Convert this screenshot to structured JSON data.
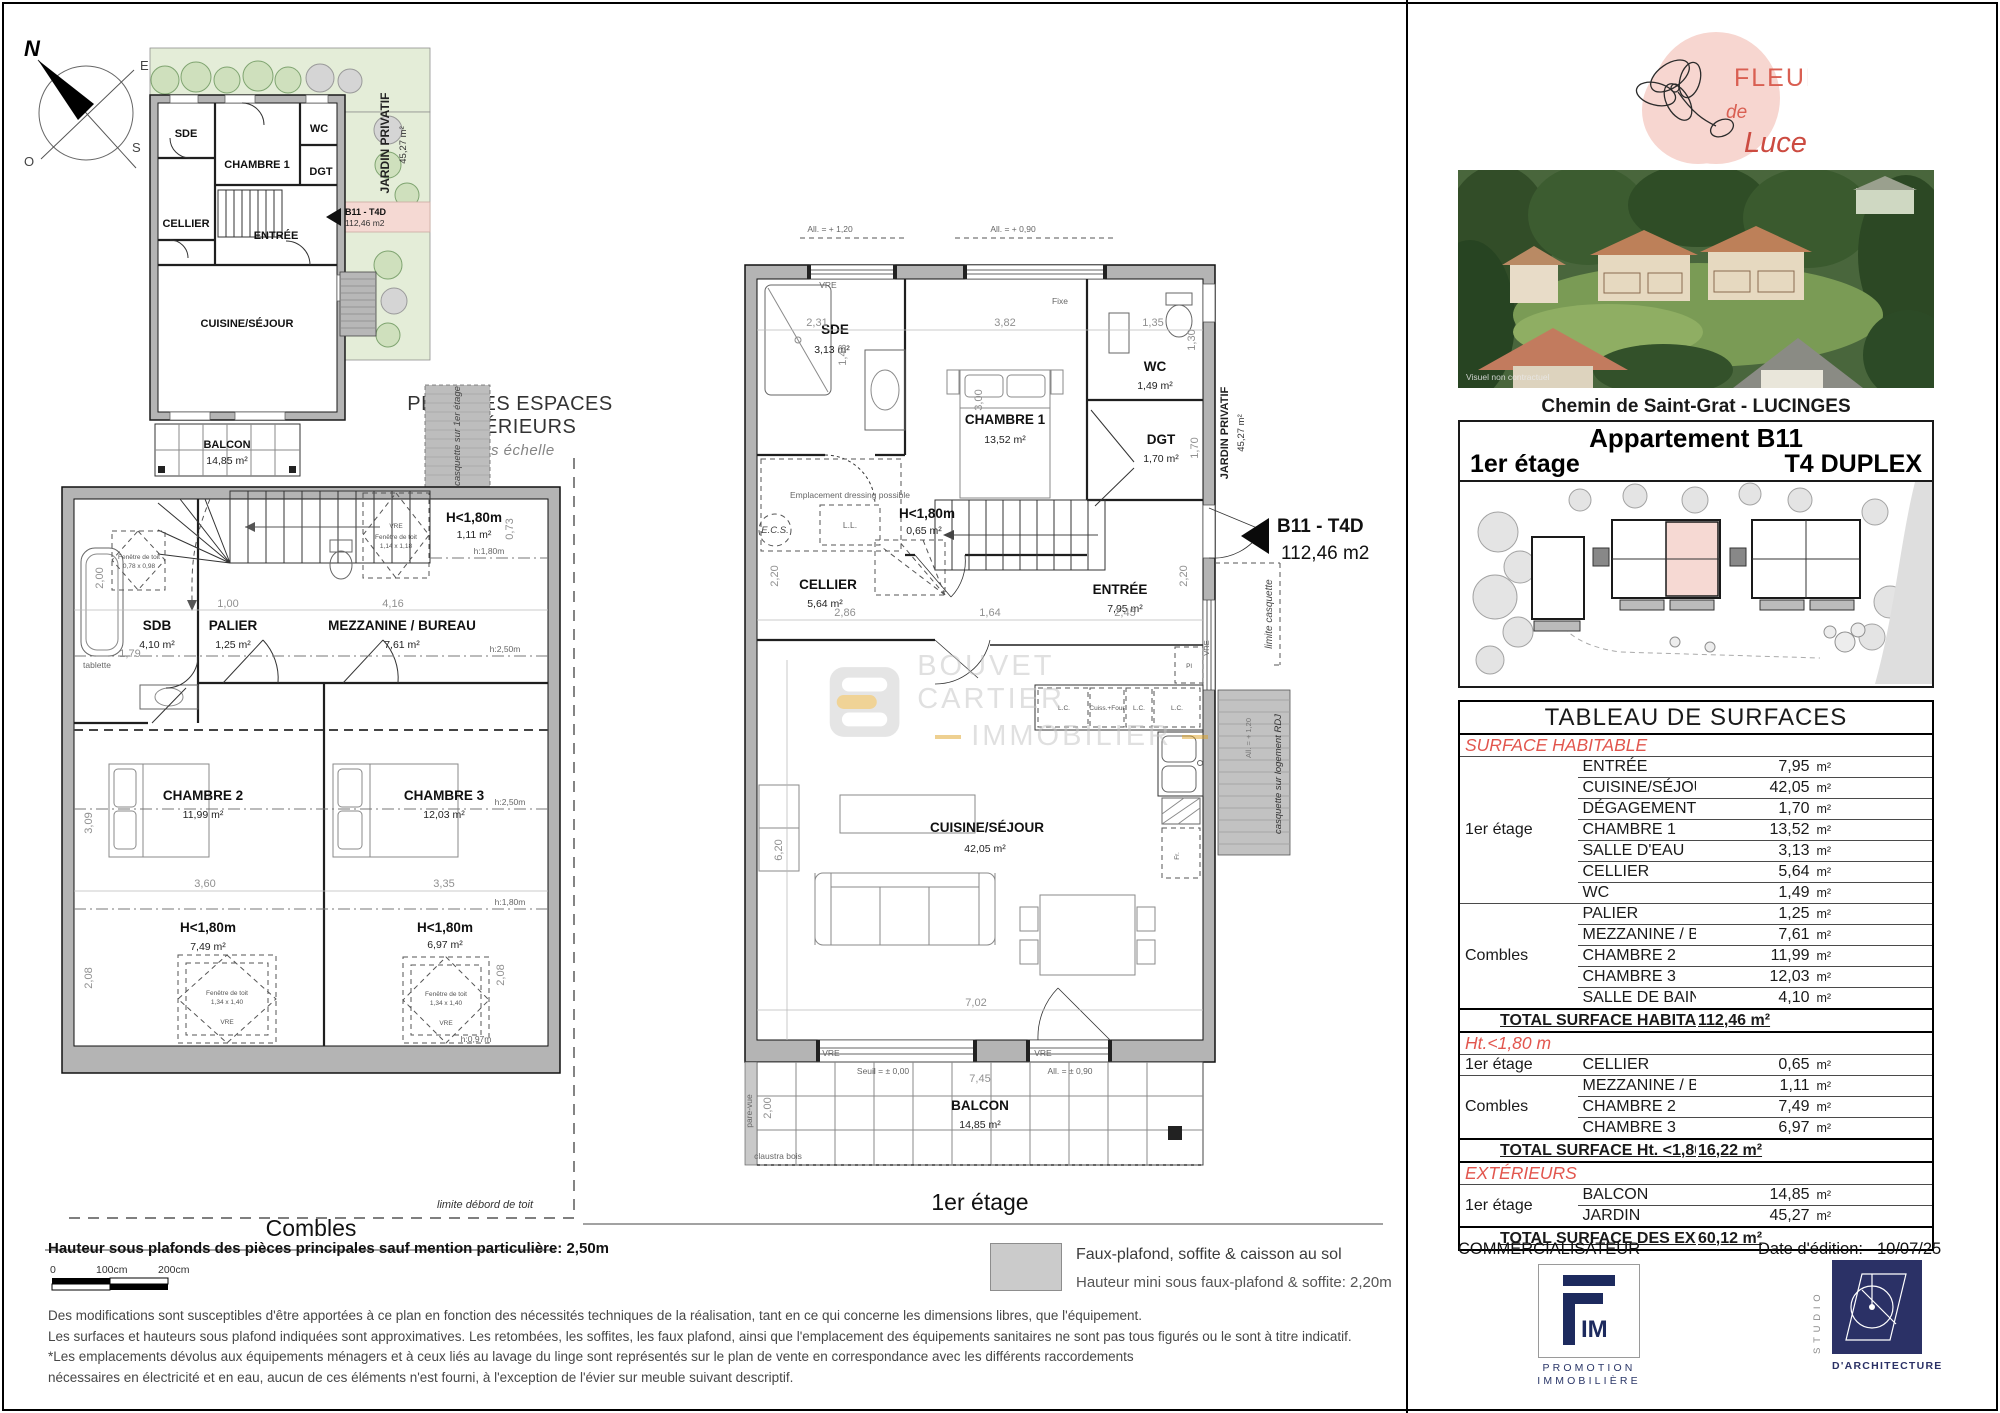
{
  "doc": {
    "commercialisateur": "COMMERCIALISATEUR",
    "edition_label": "Date d'édition:",
    "edition_date": "10/07/25"
  },
  "compass": {
    "n": "N",
    "e": "E",
    "s": "S",
    "o": "O"
  },
  "pe": {
    "title": "PLAN DES ESPACES EXTÉRIEURS",
    "subtitle": "sans échelle",
    "sde": "SDE",
    "ch1": "CHAMBRE 1",
    "wc": "WC",
    "dgt": "DGT",
    "cellier": "CELLIER",
    "entree": "ENTRÉE",
    "cuisine": "CUISINE/SÉJOUR",
    "balcon": "BALCON",
    "balcon_a": "14,85 m²",
    "jardin": "JARDIN PRIVATIF",
    "jardin_a": "45,27 m²",
    "tag_code": "B11 - T4D",
    "tag_area": "112,46 m2"
  },
  "pc": {
    "caption": "Combles",
    "sdb": "SDB",
    "sdb_a": "4,10 m²",
    "palier": "PALIER",
    "palier_a": "1,25 m²",
    "mez": "MEZZANINE / BUREAU",
    "mez_a": "7,61 m²",
    "ch2": "CHAMBRE 2",
    "ch2_a": "11,99 m²",
    "ch3": "CHAMBRE 3",
    "ch3_a": "12,03 m²",
    "h180": "H<1,80m",
    "h180_top_a": "1,11 m²",
    "h180_l_a": "7,49 m²",
    "h180_r_a": "6,97 m²",
    "hl250": "h:2,50m",
    "hl180": "h:1,80m",
    "hl097": "h:0,97m",
    "tablette": "tablette",
    "vre": "VRE",
    "ft": "Fenêtre de toit",
    "ft1_s": "0,78 x 0,98",
    "ft2_s": "1,14 x 1,18",
    "ft3_s": "1,34 x 1,40",
    "casquette": "casquette sur 1er étage",
    "limite": "limite débord de toit",
    "d200": "2,00",
    "d179": "1,79",
    "d100": "1,00",
    "d416": "4,16",
    "d073": "0,73",
    "d360": "3,60",
    "d335": "3,35",
    "d309": "3,09",
    "d208": "2,08"
  },
  "p1": {
    "caption": "1er étage",
    "sde": "SDE",
    "sde_a": "3,13 m²",
    "ch1": "CHAMBRE 1",
    "ch1_a": "13,52 m²",
    "wc": "WC",
    "wc_a": "1,49 m²",
    "dgt": "DGT",
    "dgt_a": "1,70 m²",
    "cellier": "CELLIER",
    "cellier_a": "5,64 m²",
    "entree": "ENTRÉE",
    "entree_a": "7,95 m²",
    "cuisine": "CUISINE/SÉJOUR",
    "cuisine_a": "42,05 m²",
    "balcon": "BALCON",
    "balcon_a": "14,85 m²",
    "h180": "H<1,80m",
    "h180_a": "0,65 m²",
    "dressing": "Emplacement dressing possible",
    "ecs": "E.C.S.",
    "ll": "L.L.",
    "lc": "L.C.",
    "cuiss": "Cuiss.+Four",
    "pl": "Pl",
    "fr": "Fr.",
    "vre": "VRE",
    "fixe": "Fixe",
    "all120": "All. = + 1,20",
    "all090": "All. = + 0,90",
    "seuil": "Seuil = ± 0,00",
    "all090b": "All. = ± 0,90",
    "pare": "pare-vue",
    "claustra": "claustra bois",
    "jardin": "JARDIN PRIVATIF",
    "jardin_a": "45,27 m²",
    "lim_casq": "limite casquette",
    "casq_rdj": "casquette sur logement RDJ",
    "tag_code": "B11 - T4D",
    "tag_area": "112,46 m2",
    "d231": "2,31",
    "d143": "1,43",
    "d382": "3,82",
    "d300": "3,00",
    "d135": "1,35",
    "d130": "1,30",
    "d170": "1,70",
    "d220": "2,20",
    "d286": "2,86",
    "d164": "1,64",
    "d245": "2,45",
    "d620": "6,20",
    "d702": "7,02",
    "d745": "7,45",
    "d200": "2,00"
  },
  "wm": {
    "l1": "BOUVET CARTIER",
    "l2": "IMMOBILIER"
  },
  "brand": {
    "l1": "FLEUR",
    "l2": "de",
    "l3": "Luce"
  },
  "photo": {
    "caption": "Visuel non contractuel"
  },
  "right": {
    "address": "Chemin de Saint-Grat - LUCINGES",
    "apt": "Appartement B11",
    "floor": "1er étage",
    "type": "T4 DUPLEX"
  },
  "tab": {
    "title": "TABLEAU DE SURFACES",
    "unit": "m²",
    "sec1": "SURFACE HABITABLE",
    "sec2": "Ht.<1,80 m",
    "sec3": "EXTÉRIEURS",
    "g1n": "1er étage",
    "g2n": "Combles",
    "g3n": "1er étage",
    "g4n": "Combles",
    "g5n": "1er étage",
    "g1": [
      {
        "l": "ENTRÉE",
        "v": "7,95"
      },
      {
        "l": "CUISINE/SÉJOUR",
        "v": "42,05"
      },
      {
        "l": "DÉGAGEMENT",
        "v": "1,70"
      },
      {
        "l": "CHAMBRE 1",
        "v": "13,52"
      },
      {
        "l": "SALLE D'EAU",
        "v": "3,13"
      },
      {
        "l": "CELLIER",
        "v": "5,64"
      },
      {
        "l": "WC",
        "v": "1,49"
      }
    ],
    "g2": [
      {
        "l": "PALIER",
        "v": "1,25"
      },
      {
        "l": "MEZZANINE / BUREAU",
        "v": "7,61"
      },
      {
        "l": "CHAMBRE 2",
        "v": "11,99"
      },
      {
        "l": "CHAMBRE 3",
        "v": "12,03"
      },
      {
        "l": "SALLE DE BAINS",
        "v": "4,10"
      }
    ],
    "tot1l": "TOTAL SURFACE HABITABLE",
    "tot1v": "112,46 m²",
    "g3": [
      {
        "l": "CELLIER",
        "v": "0,65"
      }
    ],
    "g4": [
      {
        "l": "MEZZANINE / BUREAU",
        "v": "1,11"
      },
      {
        "l": "CHAMBRE 2",
        "v": "7,49"
      },
      {
        "l": "CHAMBRE 3",
        "v": "6,97"
      }
    ],
    "tot2l": "TOTAL SURFACE Ht. <1,80 m",
    "tot2v": "16,22 m²",
    "g5": [
      {
        "l": "BALCON",
        "v": "14,85"
      },
      {
        "l": "JARDIN",
        "v": "45,27"
      }
    ],
    "tot3l": "TOTAL SURFACE  DES EXTÉRIEURS",
    "tot3v": "60,12 m²"
  },
  "logos": {
    "fim_im": "IM",
    "fim_l1": "PROMOTION",
    "fim_l2": "IMMOBILIÈRE",
    "studio_side": "STUDIO",
    "studio_sub": "D'ARCHITECTURE"
  },
  "notes": {
    "height": "Hauteur sous plafonds des pièces principales sauf mention particulière: 2,50m",
    "s0": "0",
    "s1": "100cm",
    "s2": "200cm",
    "leg1": "Faux-plafond, soffite & caisson au sol",
    "leg2": "Hauteur mini sous faux-plafond & soffite: 2,20m",
    "p1": "Des modifications sont susceptibles d'être apportées à ce plan en fonction des nécessités techniques de la réalisation, tant en ce qui concerne les dimensions libres, que l'équipement.",
    "p2": "Les surfaces et hauteurs sous plafond indiquées sont approximatives. Les retombées, les soffites, les faux plafond, ainsi que l'emplacement des équipements sanitaires ne sont pas tous figurés ou le sont à titre indicatif.",
    "p3": "*Les emplacements dévolus aux équipements ménagers et à ceux liés au lavage du linge sont représentés sur le plan de vente en correspondance avec les différents raccordements",
    "p4": "nécessaires en électricité et en eau, aucun de ces éléments n'est fourni, à l'exception de l'évier sur meuble suivant descriptif."
  }
}
